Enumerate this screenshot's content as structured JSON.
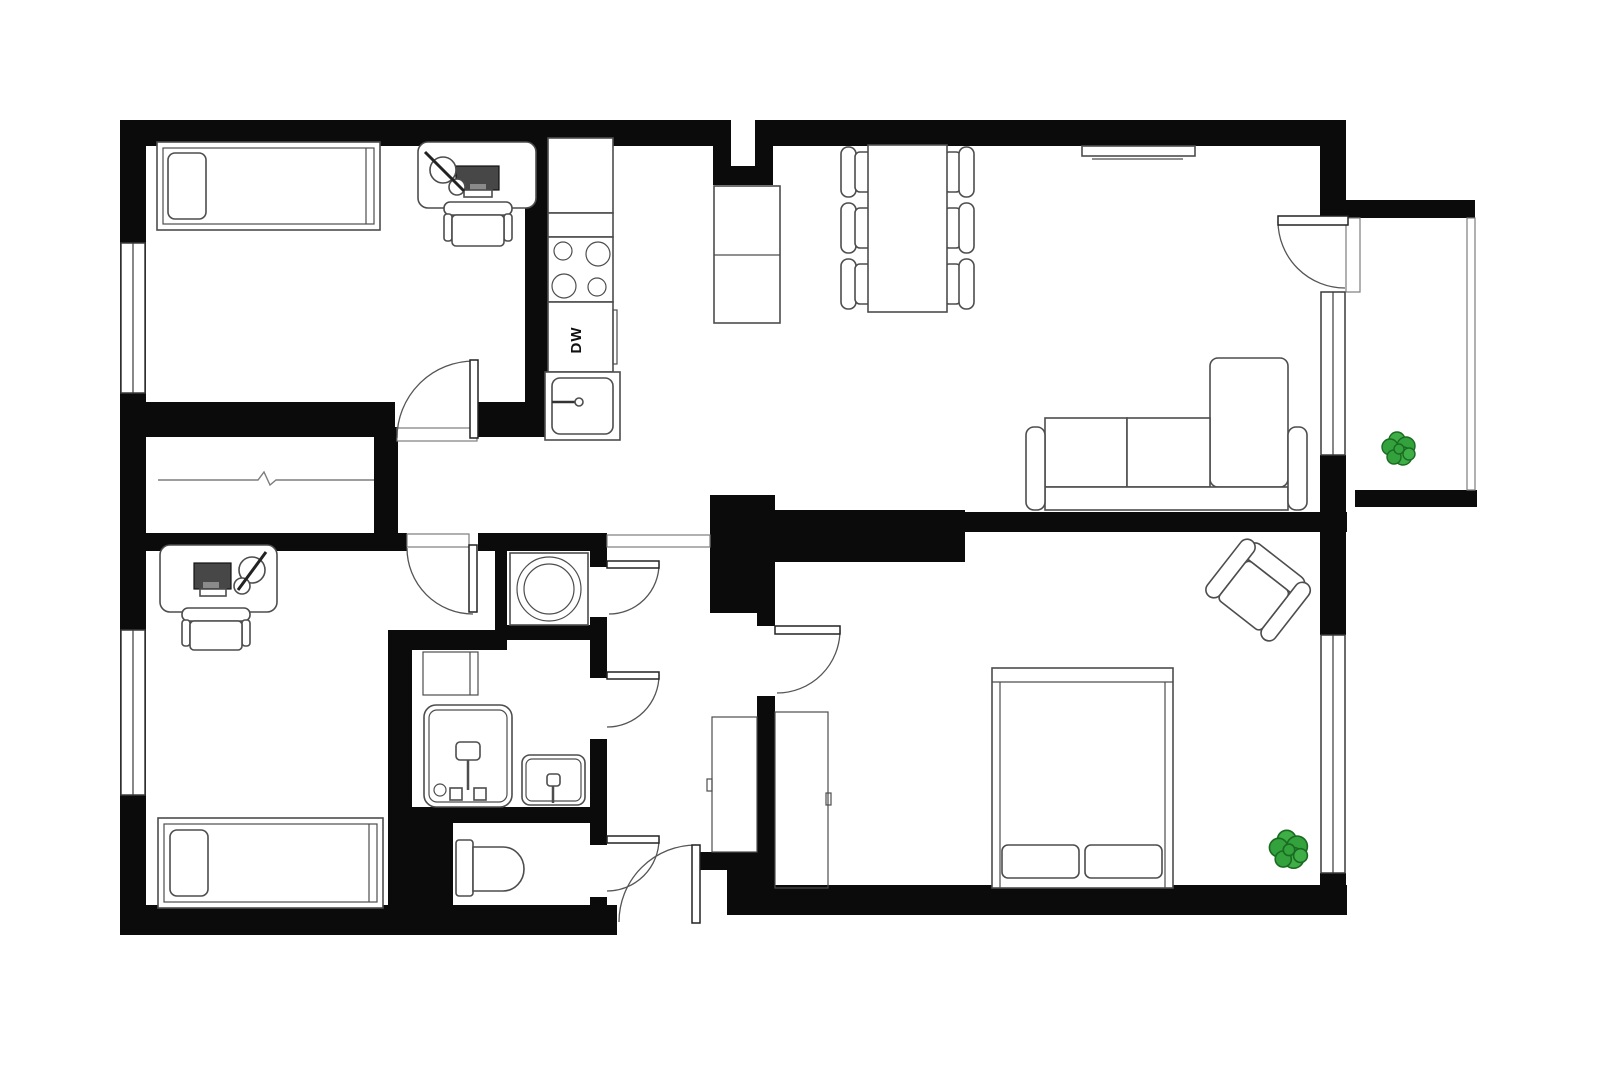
{
  "page": {
    "title": "Two-bedroom apartment floor plan",
    "type": "floor-plan",
    "background": "#ffffff"
  },
  "labels": {
    "dishwasher": "DW"
  },
  "colors": {
    "walls": "#0b0b0b",
    "furniture_outline": "#4d4d4d",
    "door_arc": "#555555",
    "plant_green": "#3fae47",
    "plant_outline": "#1a6b22",
    "monitor_fill": "#474747"
  },
  "rooms": [
    {
      "name": "bedroom-top-left",
      "furniture": [
        "single bed with pillow",
        "desk",
        "monitor",
        "desk lamp",
        "office chair",
        "window"
      ]
    },
    {
      "name": "kitchen",
      "furniture": [
        "counter",
        "cooktop with 4 burners",
        "dishwasher DW",
        "sink",
        "island cabinets"
      ]
    },
    {
      "name": "living-dining-room",
      "furniture": [
        "dining table",
        "6 chairs",
        "tv",
        "sofa with chaise",
        "balcony door",
        "window"
      ]
    },
    {
      "name": "balcony",
      "furniture": [
        "plant",
        "railing"
      ]
    },
    {
      "name": "bedroom-bottom-left",
      "furniture": [
        "desk",
        "monitor",
        "desk lamp",
        "office chair",
        "single bed with pillow",
        "window"
      ]
    },
    {
      "name": "laundry-closet",
      "furniture": [
        "washing machine"
      ]
    },
    {
      "name": "bathroom",
      "furniture": [
        "cabinet",
        "shower",
        "sink"
      ]
    },
    {
      "name": "wc",
      "furniture": [
        "toilet"
      ]
    },
    {
      "name": "hallway",
      "furniture": [
        "closet",
        "entrance door"
      ]
    },
    {
      "name": "bedroom-right",
      "furniture": [
        "double bed with 2 pillows",
        "wardrobe",
        "armchair",
        "plant",
        "window"
      ]
    }
  ]
}
